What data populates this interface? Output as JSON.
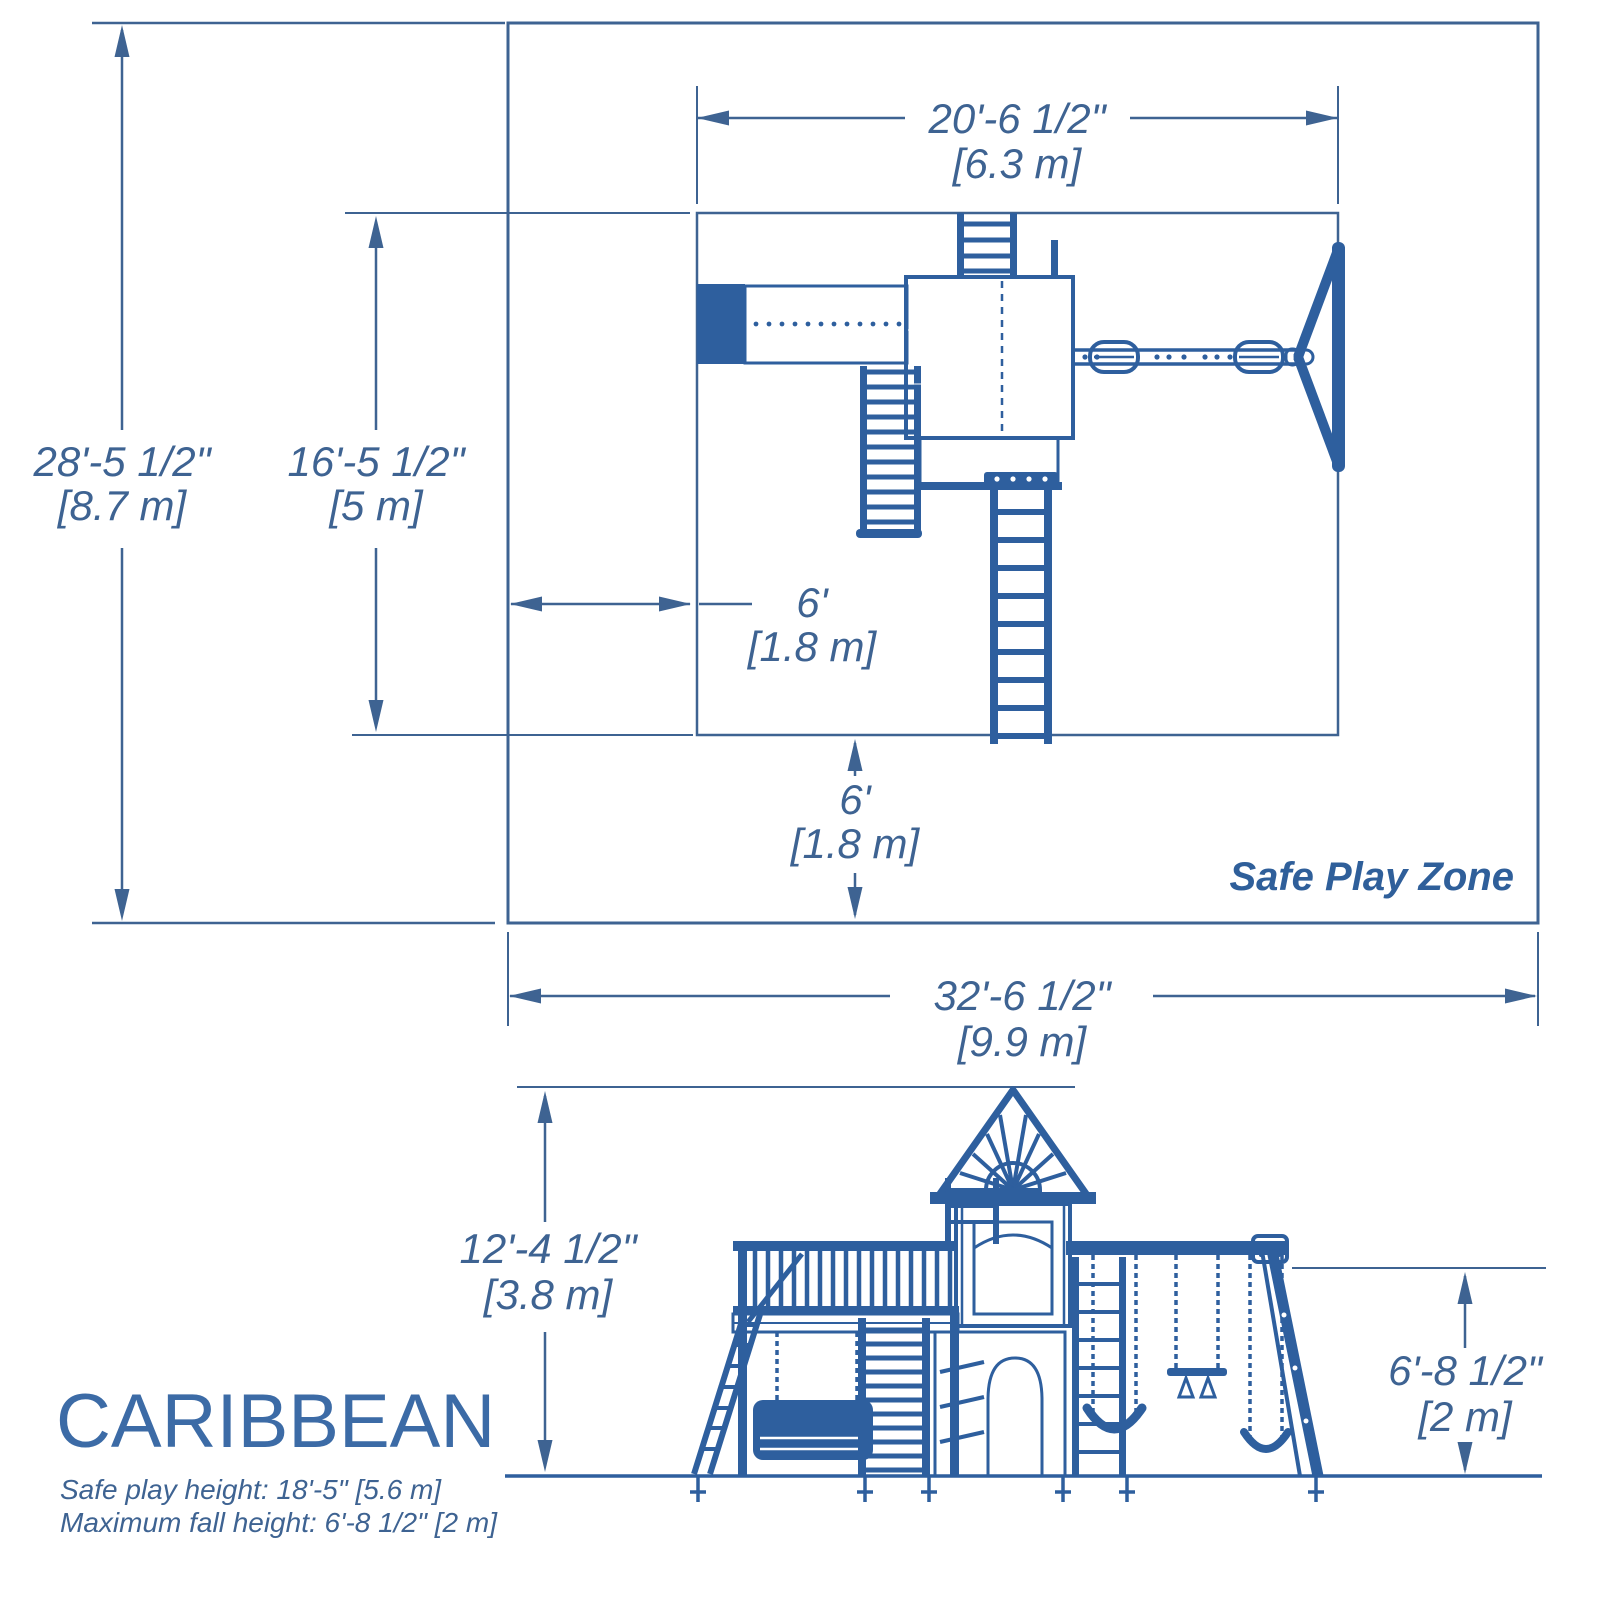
{
  "title": "CARIBBEAN",
  "notes": {
    "safe_play_height": "Safe play height: 18'-5\" [5.6 m]",
    "maximum_fall_height": "Maximum fall height: 6'-8 1/2\" [2 m]"
  },
  "plan_view": {
    "zone_label": "Safe Play Zone",
    "dims": {
      "unit_width_ft": "20'-6 1/2\"",
      "unit_width_m": "[6.3 m]",
      "zone_depth_ft": "28'-5 1/2\"",
      "zone_depth_m": "[8.7 m]",
      "unit_depth_ft": "16'-5 1/2\"",
      "unit_depth_m": "[5 m]",
      "side_clearance_ft": "6'",
      "side_clearance_m": "[1.8 m]",
      "front_clearance_ft": "6'",
      "front_clearance_m": "[1.8 m]",
      "zone_width_ft": "32'-6 1/2\"",
      "zone_width_m": "[9.9 m]"
    }
  },
  "elevation_view": {
    "dims": {
      "overall_height_ft": "12'-4 1/2\"",
      "overall_height_m": "[3.8 m]",
      "beam_height_ft": "6'-8 1/2\"",
      "beam_height_m": "[2 m]"
    }
  },
  "colors": {
    "drawing_blue": "#2e5f9e",
    "dimension_blue": "#3e6392",
    "title_blue": "#3c6ba6",
    "background": "#ffffff"
  }
}
